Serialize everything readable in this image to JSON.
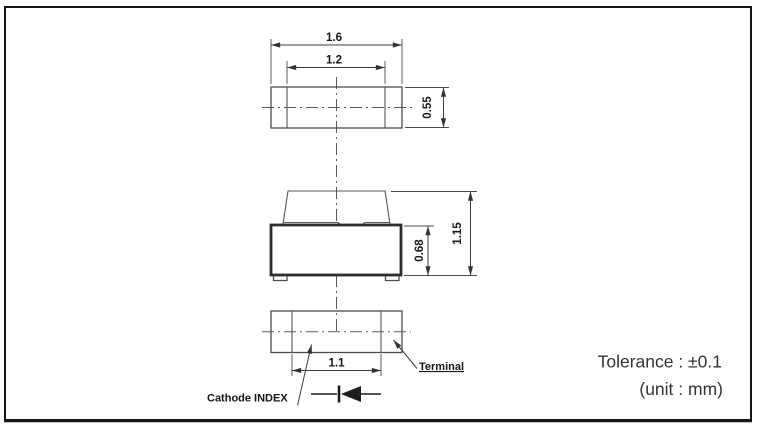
{
  "drawing": {
    "top_view": {
      "dim_outer_width": "1.6",
      "dim_inner_width": "1.2",
      "dim_depth": "0.55"
    },
    "side_view": {
      "dim_body_height": "0.68",
      "dim_total_height": "1.15"
    },
    "bottom_view": {
      "dim_terminal_span": "1.1",
      "cathode_label": "Cathode INDEX",
      "terminal_label": "Terminal"
    },
    "notes": {
      "tolerance": "Tolerance : ±0.1",
      "unit": "(unit : mm)"
    },
    "icons": {
      "diode_symbol": "diode-cathode-index-icon"
    },
    "colors": {
      "background": "#ffffff",
      "border": "#161616",
      "line": "#4c4c4c",
      "thick_line": "#2d2d2d",
      "text": "#161616",
      "note_text": "#333333"
    }
  }
}
